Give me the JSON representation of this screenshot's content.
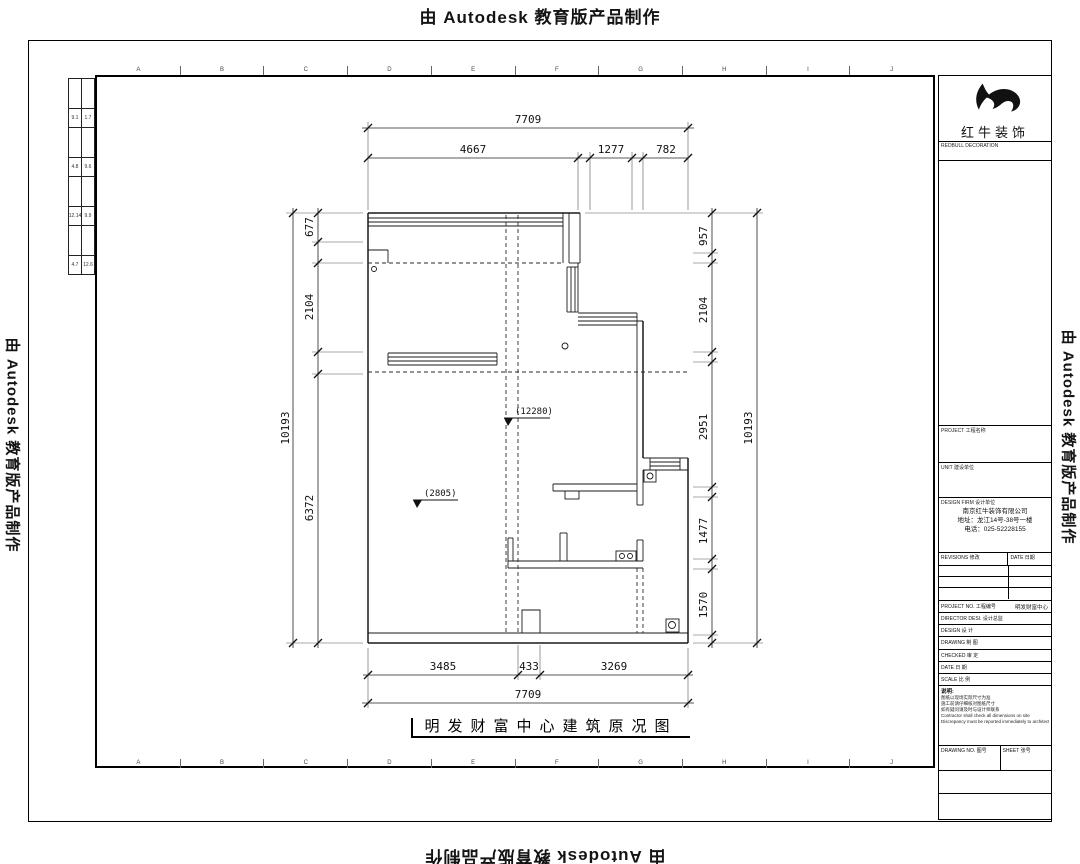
{
  "watermark": {
    "text": "由 Autodesk 教育版产品制作"
  },
  "frame": {
    "grid_letters": [
      "A",
      "B",
      "C",
      "D",
      "E",
      "F",
      "G",
      "H",
      "I",
      "J"
    ]
  },
  "mini_table": {
    "rows": [
      [
        "",
        ""
      ],
      [
        "9.1",
        "1.7"
      ],
      [
        "",
        ""
      ],
      [
        "4.8",
        "9.6"
      ],
      [
        "",
        ""
      ],
      [
        "12.14",
        "9.9"
      ],
      [
        "",
        ""
      ],
      [
        "4.7",
        "12.6"
      ]
    ]
  },
  "title_block": {
    "company_name": "红牛装饰",
    "company_sub": "REDBULL DECORATION",
    "field_project": "PROJECT 工程名称",
    "field_unit": "UNIT 建设单位",
    "field_design_firm": "DESIGN FIRM 设计单位",
    "firm_lines": [
      "南京红牛装饰有限公司",
      "地址：龙江14号-38号一楼",
      "电话：025-52228155"
    ],
    "revisions": {
      "col1": "REVISIONS 修改",
      "col2": "DATE 日期"
    },
    "info_rows": [
      {
        "label": "PROJECT NO. 工程编号",
        "value": "明发财富中心"
      },
      {
        "label": "DIRECTOR DESI. 设计总监",
        "value": ""
      },
      {
        "label": "DESIGN 设 计",
        "value": ""
      },
      {
        "label": "DRAWING 制 图",
        "value": ""
      },
      {
        "label": "CHECKED 审 定",
        "value": ""
      },
      {
        "label": "DATE 日 期",
        "value": ""
      },
      {
        "label": "SCALE 比 例",
        "value": ""
      }
    ],
    "notes_title": "说明:",
    "notes": [
      "图纸以现场实际尺寸为准",
      "施工前请仔细核对图纸尺寸",
      "如有疑问请及时与设计师联系",
      "Contractor shall check all dimensions on site",
      "Discrepancy must be reported immediately to architects"
    ],
    "bottom_drawing_no": "DRAWING NO. 图号",
    "bottom_sheet": "SHEET 张号"
  },
  "plan": {
    "title": "明发财富中心建筑原况图",
    "elevation_marks": [
      "(12280)",
      "(2805)"
    ],
    "dims": {
      "top_overall": "7709",
      "top_segments": [
        "4667",
        "1277",
        "782"
      ],
      "left_overall": "10193",
      "left_segments": [
        "677",
        "2104",
        "6372"
      ],
      "right_overall": "10193",
      "right_segments": [
        "957",
        "2104",
        "2951",
        "1477",
        "1570"
      ],
      "bottom_overall": "7709",
      "bottom_segments": [
        "3485",
        "433",
        "3269"
      ]
    }
  }
}
